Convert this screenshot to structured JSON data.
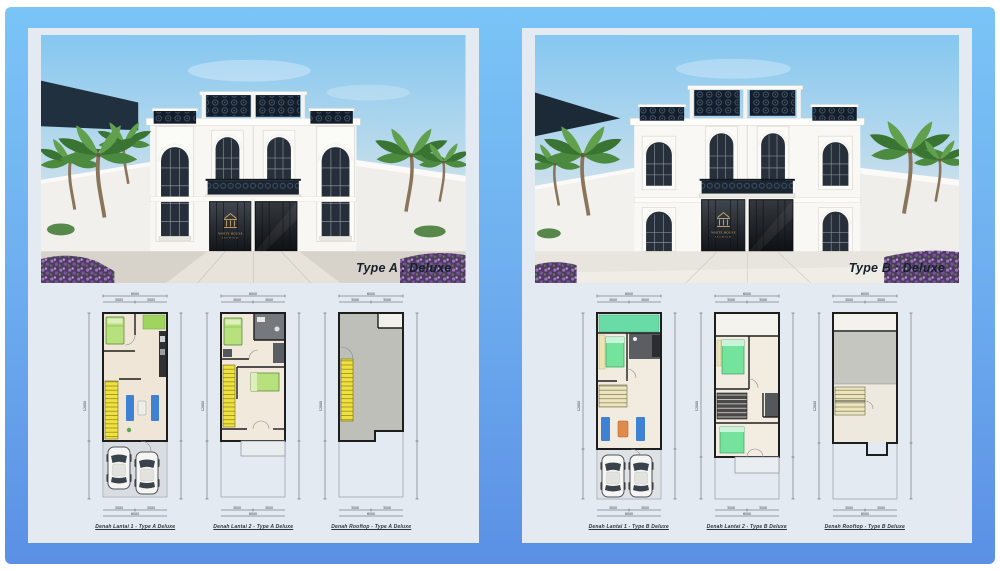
{
  "colors": {
    "gradient_top": "#7ac4f6",
    "gradient_bottom": "#5b90e5",
    "panel_bg": "#e4eaf2",
    "label_color": "#16202c",
    "logo_gold": "#cfa96d",
    "ornament_dark": "#131e2a",
    "stair_yellow": "#f0e23e",
    "bed_green_a": "#b7e17d",
    "bed_green_b": "#74e39c",
    "sofa_blue": "#3f82d4",
    "garden_teal": "#69dba7"
  },
  "panels": [
    {
      "id": "type-a",
      "label": "Type A : Deluxe",
      "logo": {
        "name": "WHITE HOUSE",
        "tagline": "PREMIUM"
      },
      "plans": [
        {
          "caption": "Denah Lantai 1 - Type A Deluxe",
          "dim_w1": "3000",
          "dim_w2": "3000",
          "dim_total": "6000",
          "dim_side": "12000"
        },
        {
          "caption": "Denah Lantai 2 - Type A Deluxe",
          "dim_w1": "3000",
          "dim_w2": "3000",
          "dim_total": "6000",
          "dim_side": "12000"
        },
        {
          "caption": "Denah Rooftop - Type A Deluxe",
          "dim_w1": "3000",
          "dim_w2": "3000",
          "dim_total": "6000",
          "dim_side": "12000"
        }
      ]
    },
    {
      "id": "type-b",
      "label": "Type B : Deluxe",
      "logo": {
        "name": "WHITE HOUSE",
        "tagline": "PREMIUM"
      },
      "plans": [
        {
          "caption": "Denah Lantai 1 - Type B Deluxe",
          "dim_w1": "3000",
          "dim_w2": "3000",
          "dim_total": "6000",
          "dim_side": "12000"
        },
        {
          "caption": "Denah Lantai 2 - Type B Deluxe",
          "dim_w1": "3000",
          "dim_w2": "3000",
          "dim_total": "6000",
          "dim_side": "12000"
        },
        {
          "caption": "Denah Rooftop - Type B Deluxe",
          "dim_w1": "3000",
          "dim_w2": "3000",
          "dim_total": "6000",
          "dim_side": "12000"
        }
      ]
    }
  ]
}
